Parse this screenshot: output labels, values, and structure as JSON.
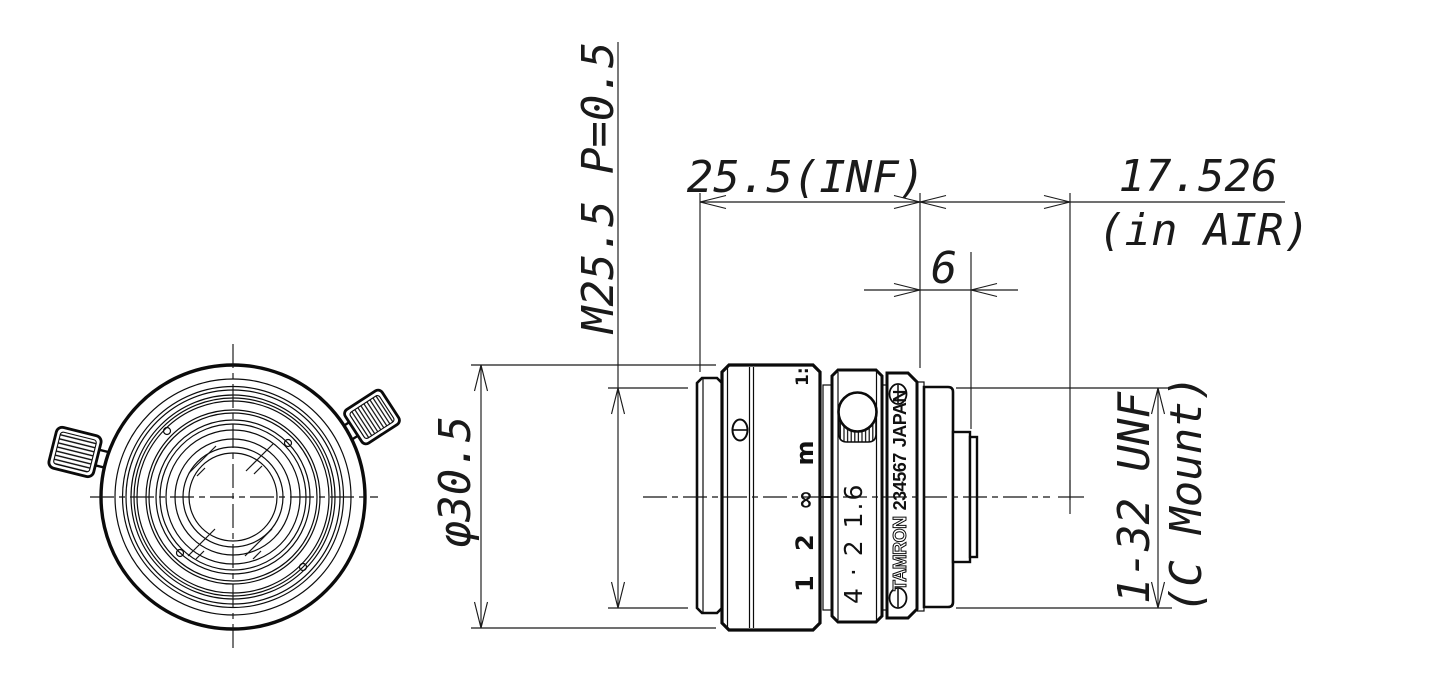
{
  "title": "C-mount machine vision lens - dimensional drawing",
  "dimensions": {
    "filter_thread": "M25.5 P=0.5",
    "length_to_flange": "25.5(INF)",
    "flange_focal_distance": "17.526",
    "flange_focal_note": "(in AIR)",
    "thread_length": "6",
    "outer_diameter": "φ30.5",
    "mount_thread": "1-32 UNF",
    "mount_name": "(C Mount)"
  },
  "barrel_markings": {
    "aperture_ratio": "1:",
    "focus_scale": "1 2 ∞ m",
    "aperture_scale": "4 · 2 1.6",
    "brand": "TAMRON",
    "serial": "234567",
    "country": "JAPAN"
  }
}
